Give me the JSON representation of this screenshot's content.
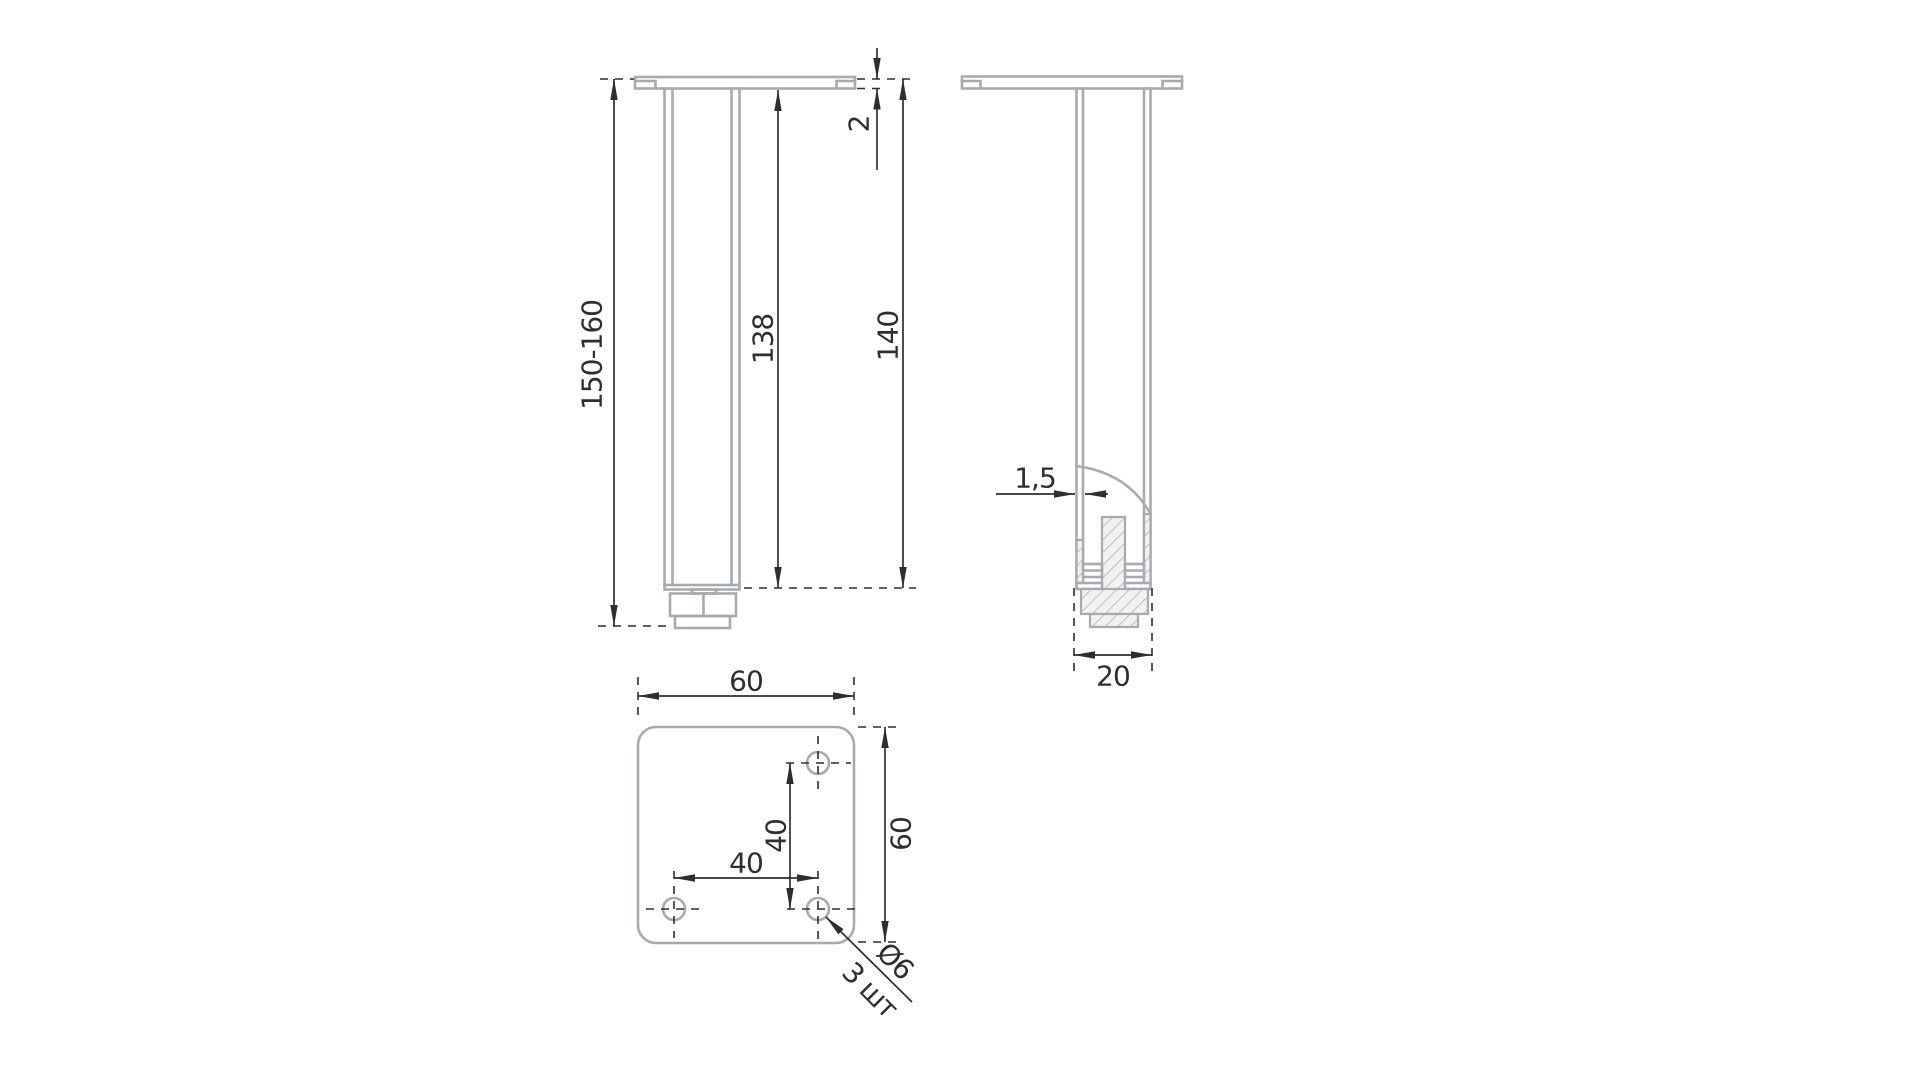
{
  "drawing": {
    "title": "adjustable-furniture-leg-drawing",
    "front_view": {
      "adjustable_height": "150-160",
      "tube_length": "138",
      "fixed_length": "140",
      "plate_thickness": "2"
    },
    "side_view": {
      "wall_thickness": "1,5",
      "tube_width": "20"
    },
    "top_view": {
      "plate_width": "60",
      "plate_depth": "60",
      "hole_pitch_horizontal": "40",
      "hole_pitch_vertical": "40",
      "hole_diameter": "Ø6",
      "hole_quantity": "3 шт"
    },
    "colors": {
      "geometry": "#a7abaf",
      "dimensions": "#2c2e30",
      "hatch_fill": "#f2f2f3",
      "background": "#ffffff"
    }
  }
}
